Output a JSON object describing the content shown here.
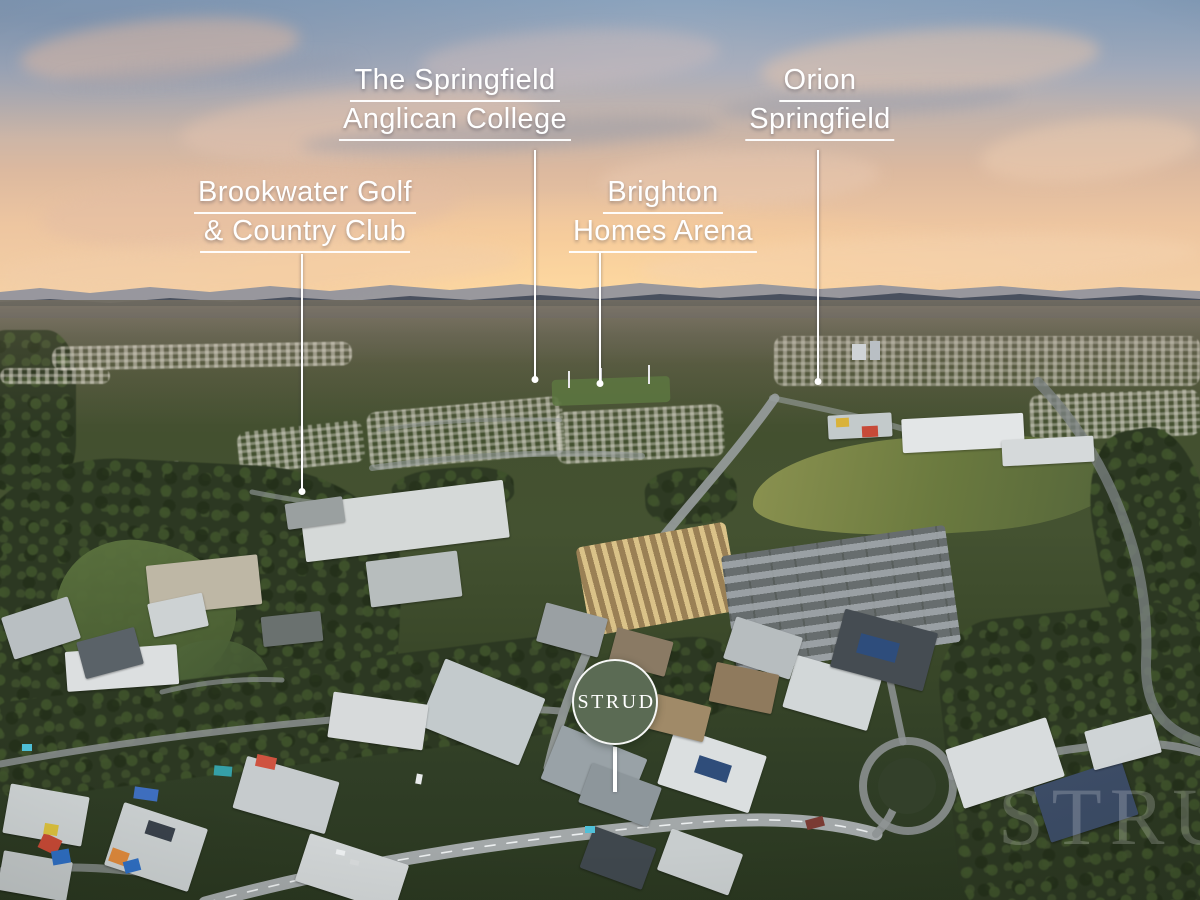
{
  "callouts": [
    {
      "name": "springfield-anglican-college",
      "line1": "The Springfield",
      "line2": "Anglican College"
    },
    {
      "name": "orion-springfield",
      "line1": "Orion",
      "line2": "Springfield"
    },
    {
      "name": "brookwater-golf-country-club",
      "line1": "Brookwater Golf",
      "line2": "& Country Club"
    },
    {
      "name": "brighton-homes-arena",
      "line1": "Brighton",
      "line2": "Homes Arena"
    }
  ],
  "badge": {
    "label": "STRUD"
  },
  "watermark": {
    "text": "STRUD"
  },
  "colors": {
    "badge_bg": "#5b6b54",
    "label_text": "#ffffff",
    "leader_line": "#ffffff"
  }
}
